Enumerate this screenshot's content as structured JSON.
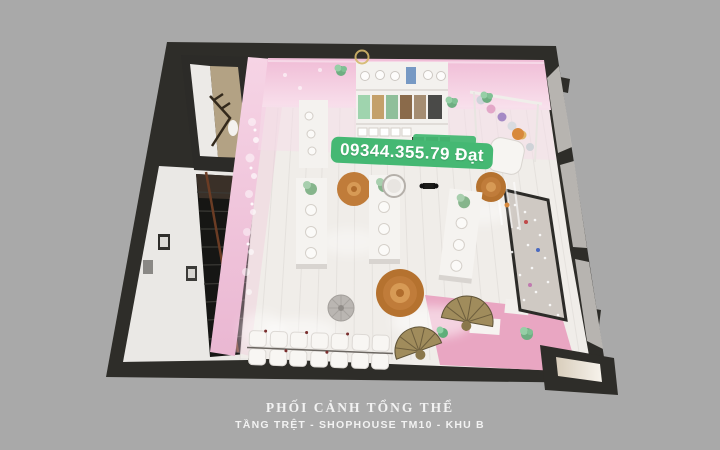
{
  "watermark": {
    "text": "09344.355.79 Đạt",
    "bg_color": "#45b873",
    "text_color": "#ffffff"
  },
  "caption": {
    "title": "PHỐI CẢNH TỔNG THỂ",
    "subtitle": "TẦNG TRỆT - SHOPHOUSE TM10 - KHU B",
    "text_color": "#f2f2f2"
  },
  "scene": {
    "type": "3d-interior-perspective-render",
    "background_color": "#a9a9a9",
    "palette": {
      "wall": "#2e2d29",
      "pink_wall": "#f1c6db",
      "salon_floor": "#f0ede9",
      "pink_floor": "#e9a6c2",
      "rattan_mat": "#c07c3a",
      "staircase": "#161614",
      "glass": "#c6c3bf",
      "wc_floor": "#b3a284"
    }
  }
}
